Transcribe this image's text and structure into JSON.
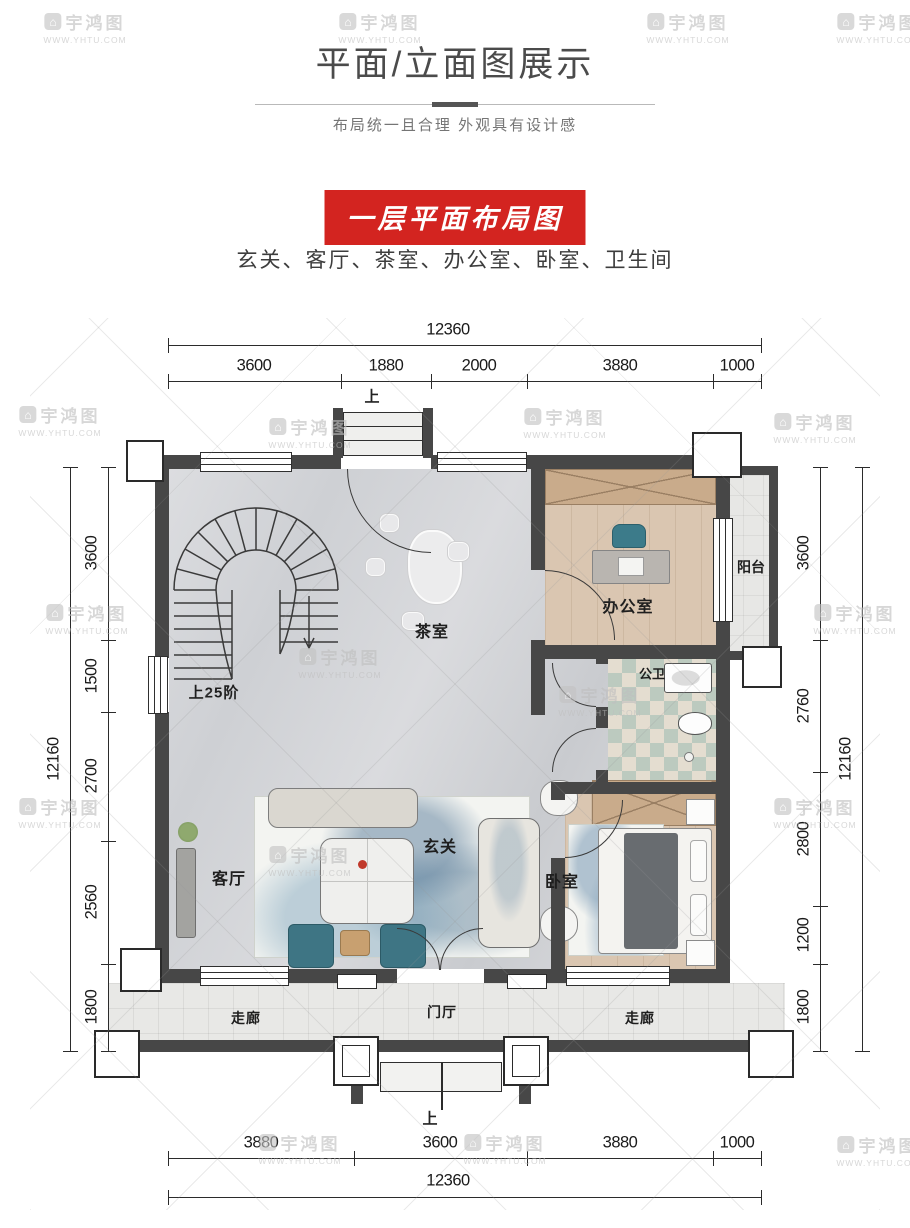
{
  "header": {
    "title": "平面/立面图展示",
    "subtitle": "布局统一且合理 外观具有设计感"
  },
  "section": {
    "badge": "一层平面布局图",
    "room_list": "玄关、客厅、茶室、办公室、卧室、卫生间"
  },
  "watermark": {
    "brand": "宇鸿图",
    "url": "WWW.YHTU.COM"
  },
  "plan": {
    "labels": {
      "stairs": "上25阶",
      "tea_room": "茶室",
      "office": "办公室",
      "balcony": "阳台",
      "bathroom": "公卫",
      "hall": "玄关",
      "living_room": "客厅",
      "bedroom": "卧室",
      "corridor_left": "走廊",
      "entry_hall": "门厅",
      "corridor_right": "走廊",
      "up_top": "上",
      "up_bottom": "上"
    },
    "dimensions": {
      "top": {
        "total": "12360",
        "segments": [
          "3600",
          "1880",
          "2000",
          "3880",
          "1000"
        ]
      },
      "bottom": {
        "total": "12360",
        "segments": [
          "3880",
          "3600",
          "3880",
          "1000"
        ]
      },
      "left": {
        "total": "12160",
        "segments": [
          "3600",
          "1500",
          "2700",
          "2560",
          "1800"
        ]
      },
      "right": {
        "total": "12160",
        "segments": [
          "3600",
          "2760",
          "2800",
          "1200",
          "1800"
        ]
      }
    },
    "colors": {
      "accent_red": "#d32420",
      "wall": "#474747",
      "wood_floor": "#dac6b1",
      "marble_floor": "#d4d5d8"
    }
  }
}
